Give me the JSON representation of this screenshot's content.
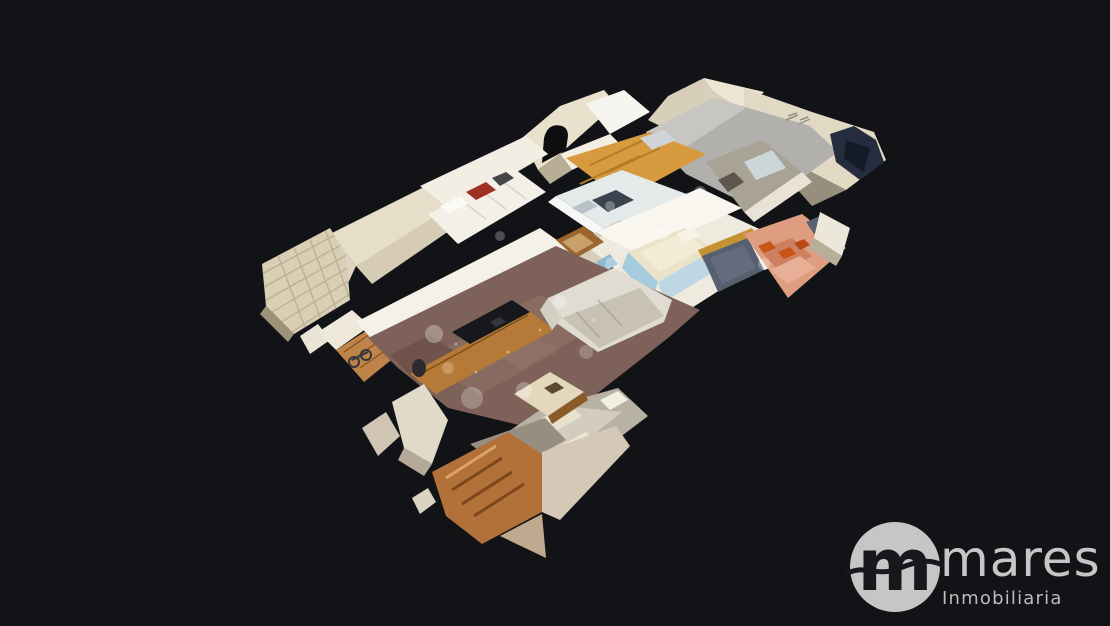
{
  "viewer": {
    "type": "3d-dollhouse-property-tour",
    "background_color": "#111316",
    "model_kind": "apartment-cutaway-scan",
    "rooms": [
      "living-room",
      "kitchen",
      "main-bedroom",
      "wardrobe-bedroom",
      "arched-bathroom",
      "side-bathroom",
      "terrace",
      "entry-hall"
    ]
  },
  "branding": {
    "monogram": "m",
    "name": "mares",
    "tagline": "Inmobiliaria"
  },
  "colors": {
    "bg": "#111316",
    "logo-gray": "#c6c6c6",
    "logo-dark": "#17181b",
    "wall-cream": "#e7dec9",
    "wall-white": "#f4f1e8",
    "wood-cabinet": "#d79a3e",
    "wood-furniture": "#b57a38",
    "floor-living": "#7e6158",
    "sofa-gray": "#c7c2b5",
    "terrace-salmon": "#de9d81",
    "pot-orange": "#c85418",
    "window-slate": "#566070",
    "bed-blue": "#a6cbdd",
    "panel-gray": "#b2b0ac",
    "blob-navy": "#252c3d"
  }
}
